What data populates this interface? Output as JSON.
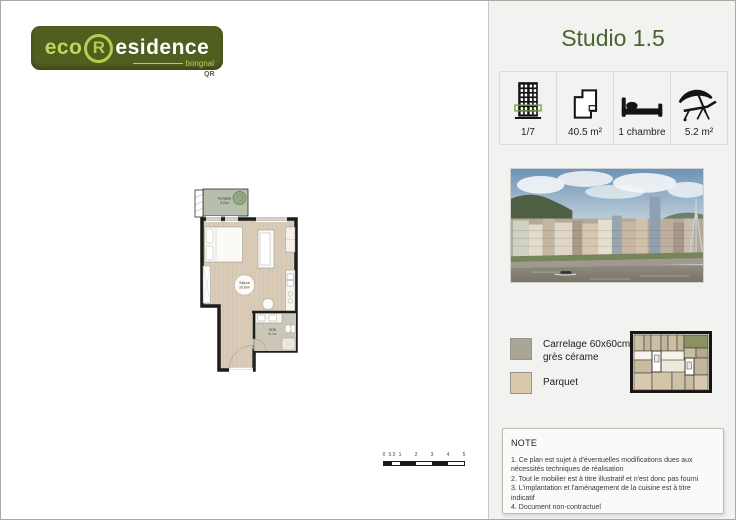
{
  "brand": {
    "eco": "eco",
    "r": "R",
    "residence": "esidence",
    "sub": "bongnal",
    "qr": "QR",
    "green_dark": "#505e1f",
    "green_light": "#b9cc52"
  },
  "header": {
    "title": "Studio 1.5",
    "accent": "#4a6332"
  },
  "stats": {
    "items": [
      {
        "icon": "building-floor-icon",
        "label": "1/7"
      },
      {
        "icon": "floorplan-outline-icon",
        "label": "40.5 m²"
      },
      {
        "icon": "bed-icon",
        "label": "1 chambre"
      },
      {
        "icon": "parasol-lounger-icon",
        "label": "5.2 m²"
      }
    ]
  },
  "photo": {
    "subject": "riverside-cityscape"
  },
  "legend": {
    "items": [
      {
        "label": "Carrelage 60x60cm grès cérame",
        "color": "#aaa695"
      },
      {
        "label": "Parquet",
        "color": "#d9c9ad"
      }
    ]
  },
  "keyplan": {
    "highlight_color": "#8b9162"
  },
  "plan": {
    "rooms": [
      {
        "name": "Terrasse",
        "area": "5.2m²"
      },
      {
        "name": "Séjour",
        "area": "29.6m²"
      },
      {
        "name": "SDB",
        "area": "5.7m²"
      }
    ],
    "colors": {
      "parquet": "#d9cbb7",
      "tile": "#cdc7ba",
      "terrace": "#b7bfae",
      "wall": "#1c1c1a"
    }
  },
  "note": {
    "heading": "NOTE",
    "items": [
      "1. Ce plan est sujet à d'éventuelles modifications dues aux nécessités techniques de réalisation",
      "2. Tout le mobilier est à titre illustratif et n'est donc pas fourni",
      "3. L'implantation et l'aménagement de la cuisine est à titre indicatif",
      "4. Document non-contractuel"
    ]
  },
  "scalebar": {
    "ticks": [
      "0",
      "0.5",
      "1",
      "2",
      "3",
      "4",
      "5"
    ]
  }
}
